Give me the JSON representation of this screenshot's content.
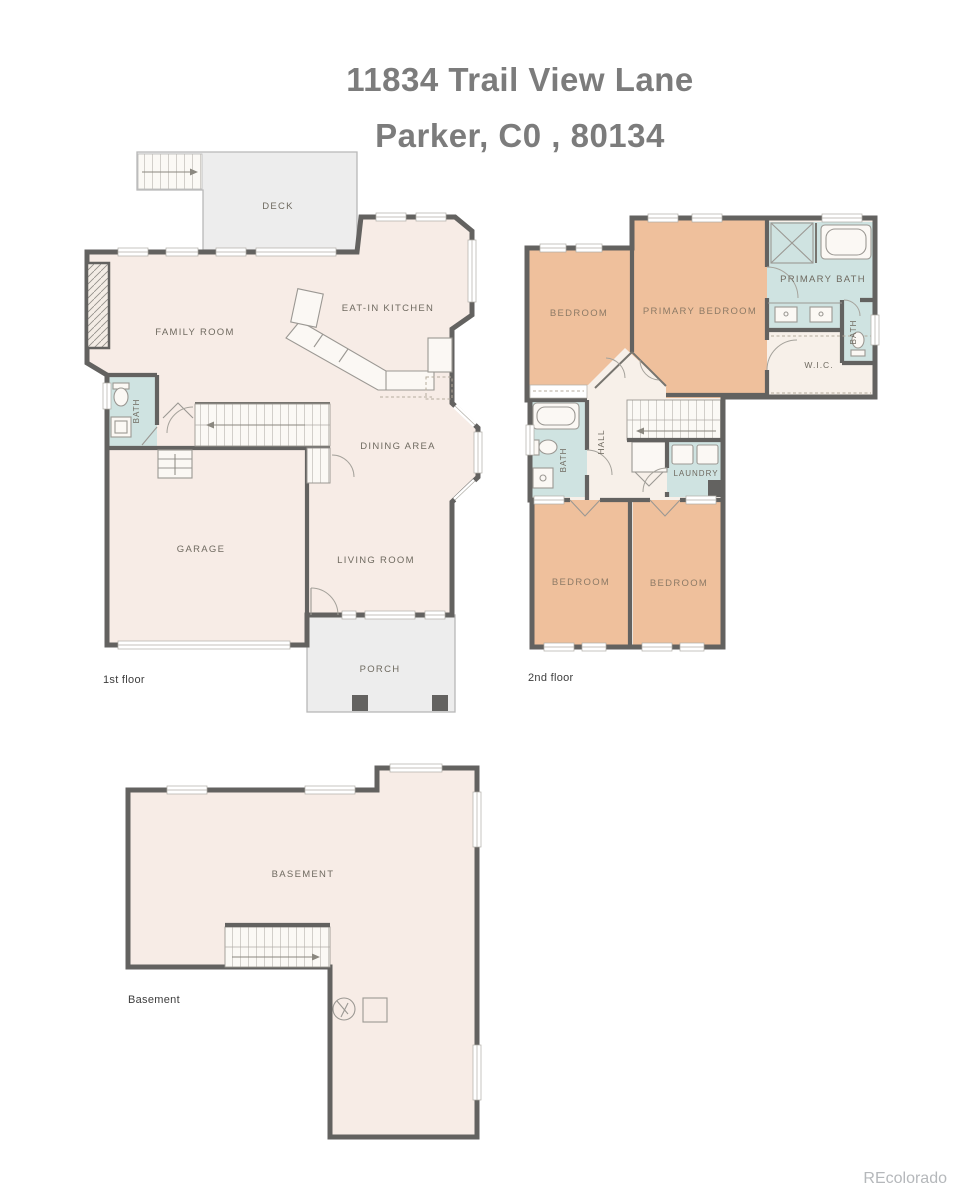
{
  "title": {
    "line1": "11834 Trail View Lane",
    "line2": "Parker, C0 , 80134"
  },
  "watermark": "REcolorado",
  "floors": {
    "first": {
      "caption": "1st floor",
      "rooms": {
        "deck": "DECK",
        "family_room": "FAMILY ROOM",
        "kitchen": "EAT-IN KITCHEN",
        "bath": "BATH",
        "dining": "DINING AREA",
        "garage": "GARAGE",
        "living": "LIVING ROOM",
        "porch": "PORCH"
      }
    },
    "second": {
      "caption": "2nd floor",
      "rooms": {
        "bedroom_tl": "BEDROOM",
        "primary_bedroom": "PRIMARY BEDROOM",
        "primary_bath": "PRIMARY BATH",
        "bath_right": "BATH",
        "wic": "W.I.C.",
        "hall": "HALL",
        "bath_left": "BATH",
        "laundry": "LAUNDRY",
        "bedroom_bl": "BEDROOM",
        "bedroom_br": "BEDROOM"
      }
    },
    "basement": {
      "caption": "Basement",
      "rooms": {
        "basement": "BASEMENT"
      }
    }
  },
  "colors": {
    "wall": "#636260",
    "floor_cream": "#f7ece6",
    "floor_tan": "#efc09c",
    "floor_teal": "#cfe3e1",
    "outdoor_gray": "#ededed",
    "label_text": "#6f6a60",
    "title_text": "#7c7c7c",
    "watermark_text": "#b5b8bb"
  }
}
